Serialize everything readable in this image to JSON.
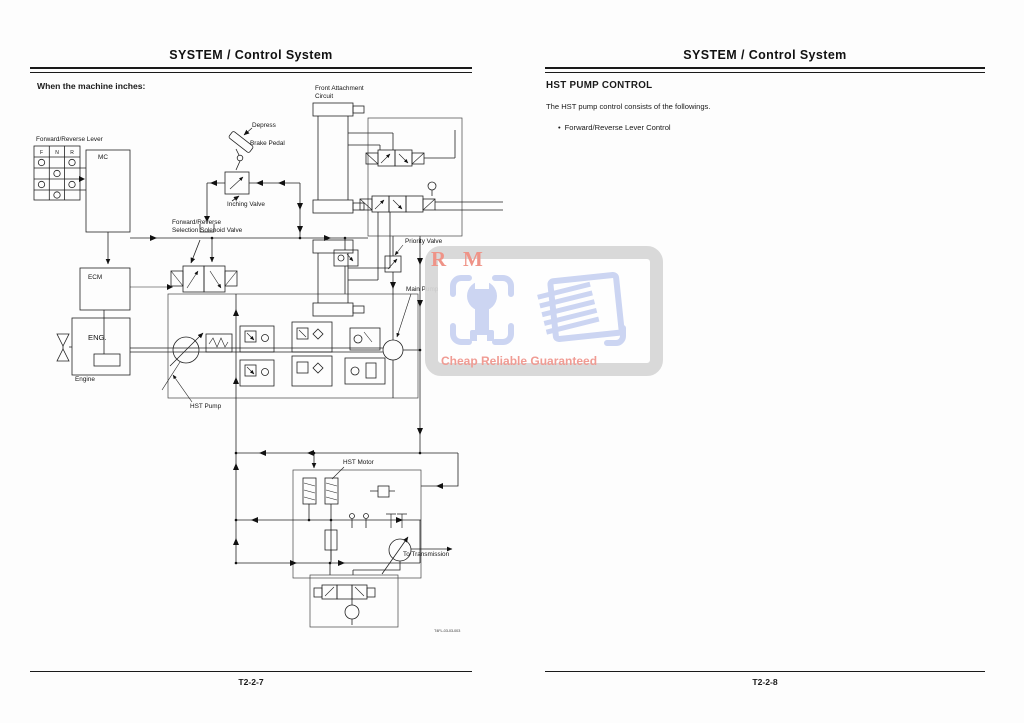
{
  "left_page": {
    "header": "SYSTEM / Control System",
    "intro": "When the machine inches:",
    "footer": "T2-2-7",
    "figure_code": "T4FL-03-03-003",
    "diagram": {
      "lever_letters": [
        "F",
        "N",
        "R"
      ],
      "labels": {
        "forward_reverse_lever": "Forward/Reverse Lever",
        "mc": "MC",
        "ecm": "ECM",
        "eng": "ENG.",
        "engine": "Engine",
        "hst_pump": "HST Pump",
        "fr_selection_valve": "Forward/Reverse\nSelection Solenoid Valve",
        "depress": "Depress",
        "brake_pedal": "Brake Pedal",
        "inching_valve": "Inching Valve",
        "front_attachment": "Front Attachment\nCircuit",
        "priority_valve": "Priority Valve",
        "main_pump": "Main Pump",
        "hst_motor": "HST Motor",
        "to_transmission": "To Transmission"
      }
    }
  },
  "right_page": {
    "header": "SYSTEM / Control System",
    "section_title": "HST PUMP CONTROL",
    "body": "The HST pump control consists of the followings.",
    "bullet_char": "•",
    "bullets": [
      "Forward/Reverse Lever Control"
    ],
    "footer": "T2-2-8"
  },
  "watermark": {
    "letter_r": "R",
    "letter_m": "M",
    "slogan": "Cheap Reliable Guaranteed",
    "colors": {
      "red": "#ee8c7f",
      "blue": "#c9d3f2",
      "gray": "#d7d7d7"
    }
  }
}
